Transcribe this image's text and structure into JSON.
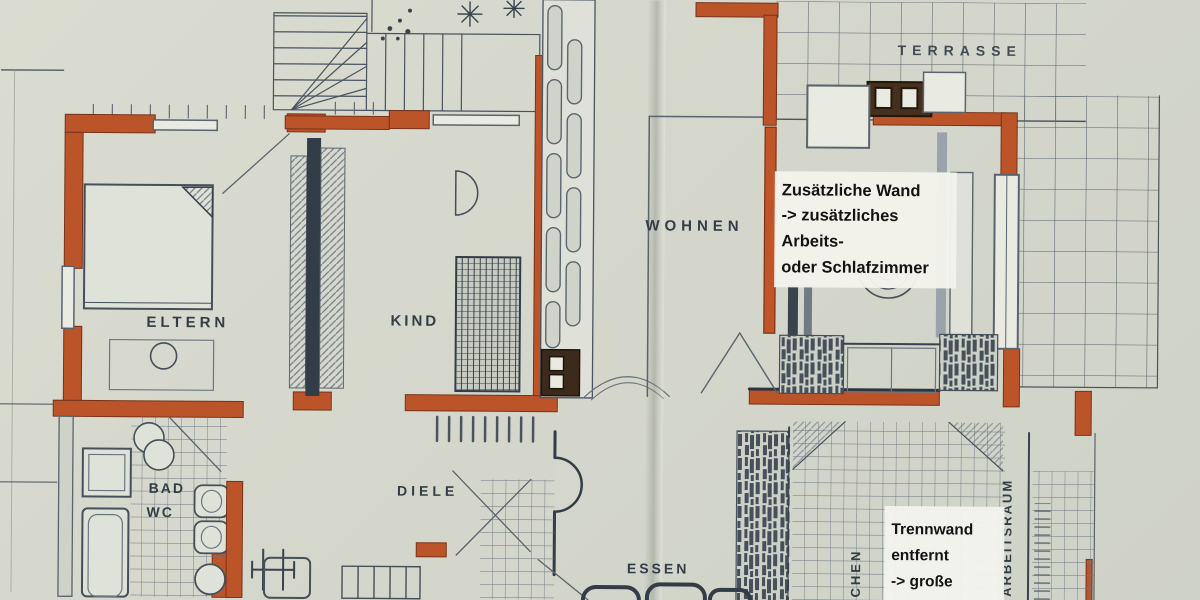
{
  "document": {
    "kind": "scanned floor plan",
    "language": "German"
  },
  "palette": {
    "paper": "#d5d7cc",
    "ink": "#39434d",
    "ink_light": "#6b7680",
    "wall_highlight": "#bc5429",
    "wall_highlight_dark": "#77331a",
    "annotation_bg": "#f3f2ec",
    "annotation_text": "#131313"
  },
  "plan": {
    "rooms": {
      "eltern": "ELTERN",
      "kind": "KIND",
      "bad": "BAD",
      "wc": "WC",
      "diele": "DIELE",
      "essen": "ESSEN",
      "wohnen": "WOHNEN",
      "terrasse": "TERRASSE",
      "kochen": "KOCHEN",
      "arbeitsraum": "ARBEITSRAUM"
    },
    "annotations": {
      "additional_wall": {
        "lines": [
          "Zusätzliche Wand",
          "-> zusätzliches",
          "Arbeits-",
          "oder Schlafzimmer"
        ]
      },
      "removed_wall": {
        "lines": [
          "Trennwand",
          "entfernt",
          "-> große",
          "Küche"
        ]
      }
    }
  }
}
